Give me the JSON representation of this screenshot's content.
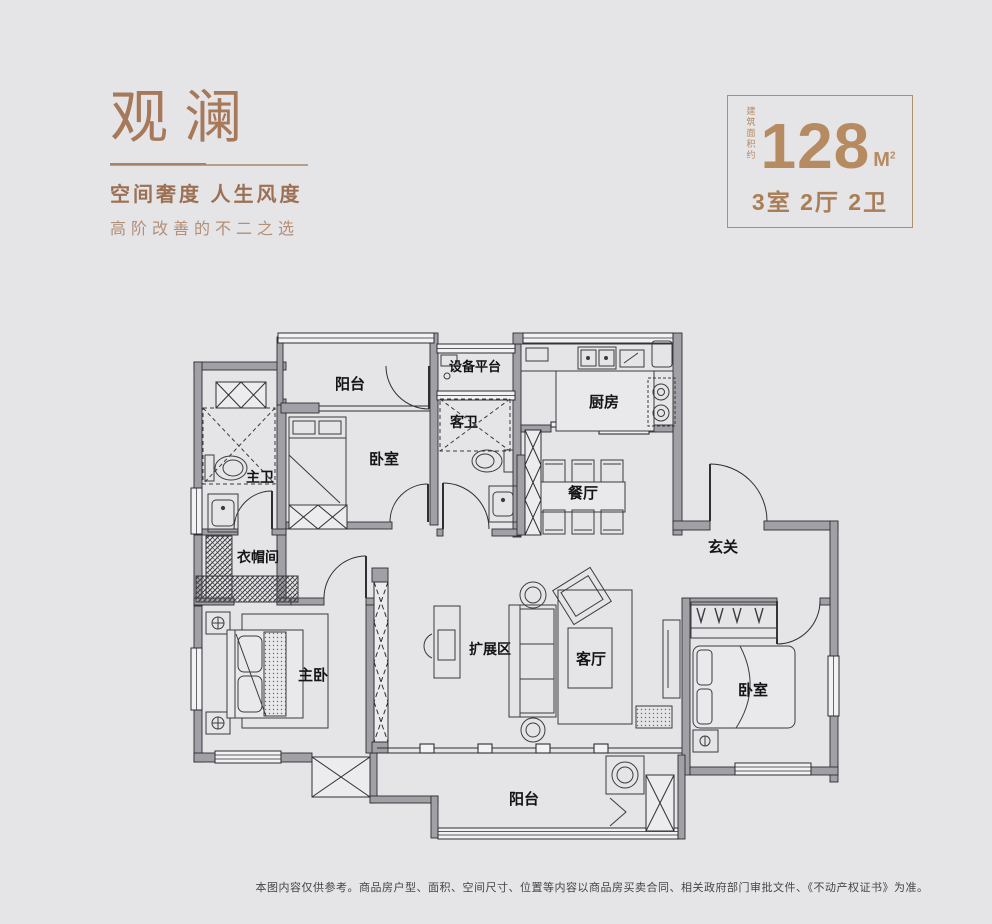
{
  "brand": {
    "title": "观澜",
    "subtitle": "空间奢度 人生风度",
    "tagline": "高阶改善的不二之选"
  },
  "spec": {
    "area_prefix": "建筑面积约",
    "area_value": "128",
    "area_unit_letter": "M",
    "area_unit_sup": "2",
    "layout": "3室 2厅 2卫"
  },
  "floorplan": {
    "rooms": [
      {
        "name": "balcony-top",
        "label": "阳台"
      },
      {
        "name": "equipment-platform",
        "label": "设备平台"
      },
      {
        "name": "kitchen",
        "label": "厨房"
      },
      {
        "name": "bedroom-top",
        "label": "卧室"
      },
      {
        "name": "guest-bath",
        "label": "客卫"
      },
      {
        "name": "master-bath",
        "label": "主卫"
      },
      {
        "name": "dining",
        "label": "餐厅"
      },
      {
        "name": "foyer",
        "label": "玄关"
      },
      {
        "name": "cloakroom",
        "label": "衣帽间"
      },
      {
        "name": "master-bedroom",
        "label": "主卧"
      },
      {
        "name": "expansion-area",
        "label": "扩展区"
      },
      {
        "name": "living-room",
        "label": "客厅"
      },
      {
        "name": "bedroom-right",
        "label": "卧室"
      },
      {
        "name": "balcony-bottom",
        "label": "阳台"
      }
    ]
  },
  "footer": {
    "disclaimer": "本图内容仅供参考。商品房户型、面积、空间尺寸、位置等内容以商品房买卖合同、相关政府部门审批文件、《不动产权证书》为准。"
  },
  "colors": {
    "background": "#e5e4e7",
    "brand_brown": "#a6795b",
    "accent_brown": "#b68b62",
    "wall_gray": "#a0a0a6",
    "line_dark": "#2d2d31"
  }
}
